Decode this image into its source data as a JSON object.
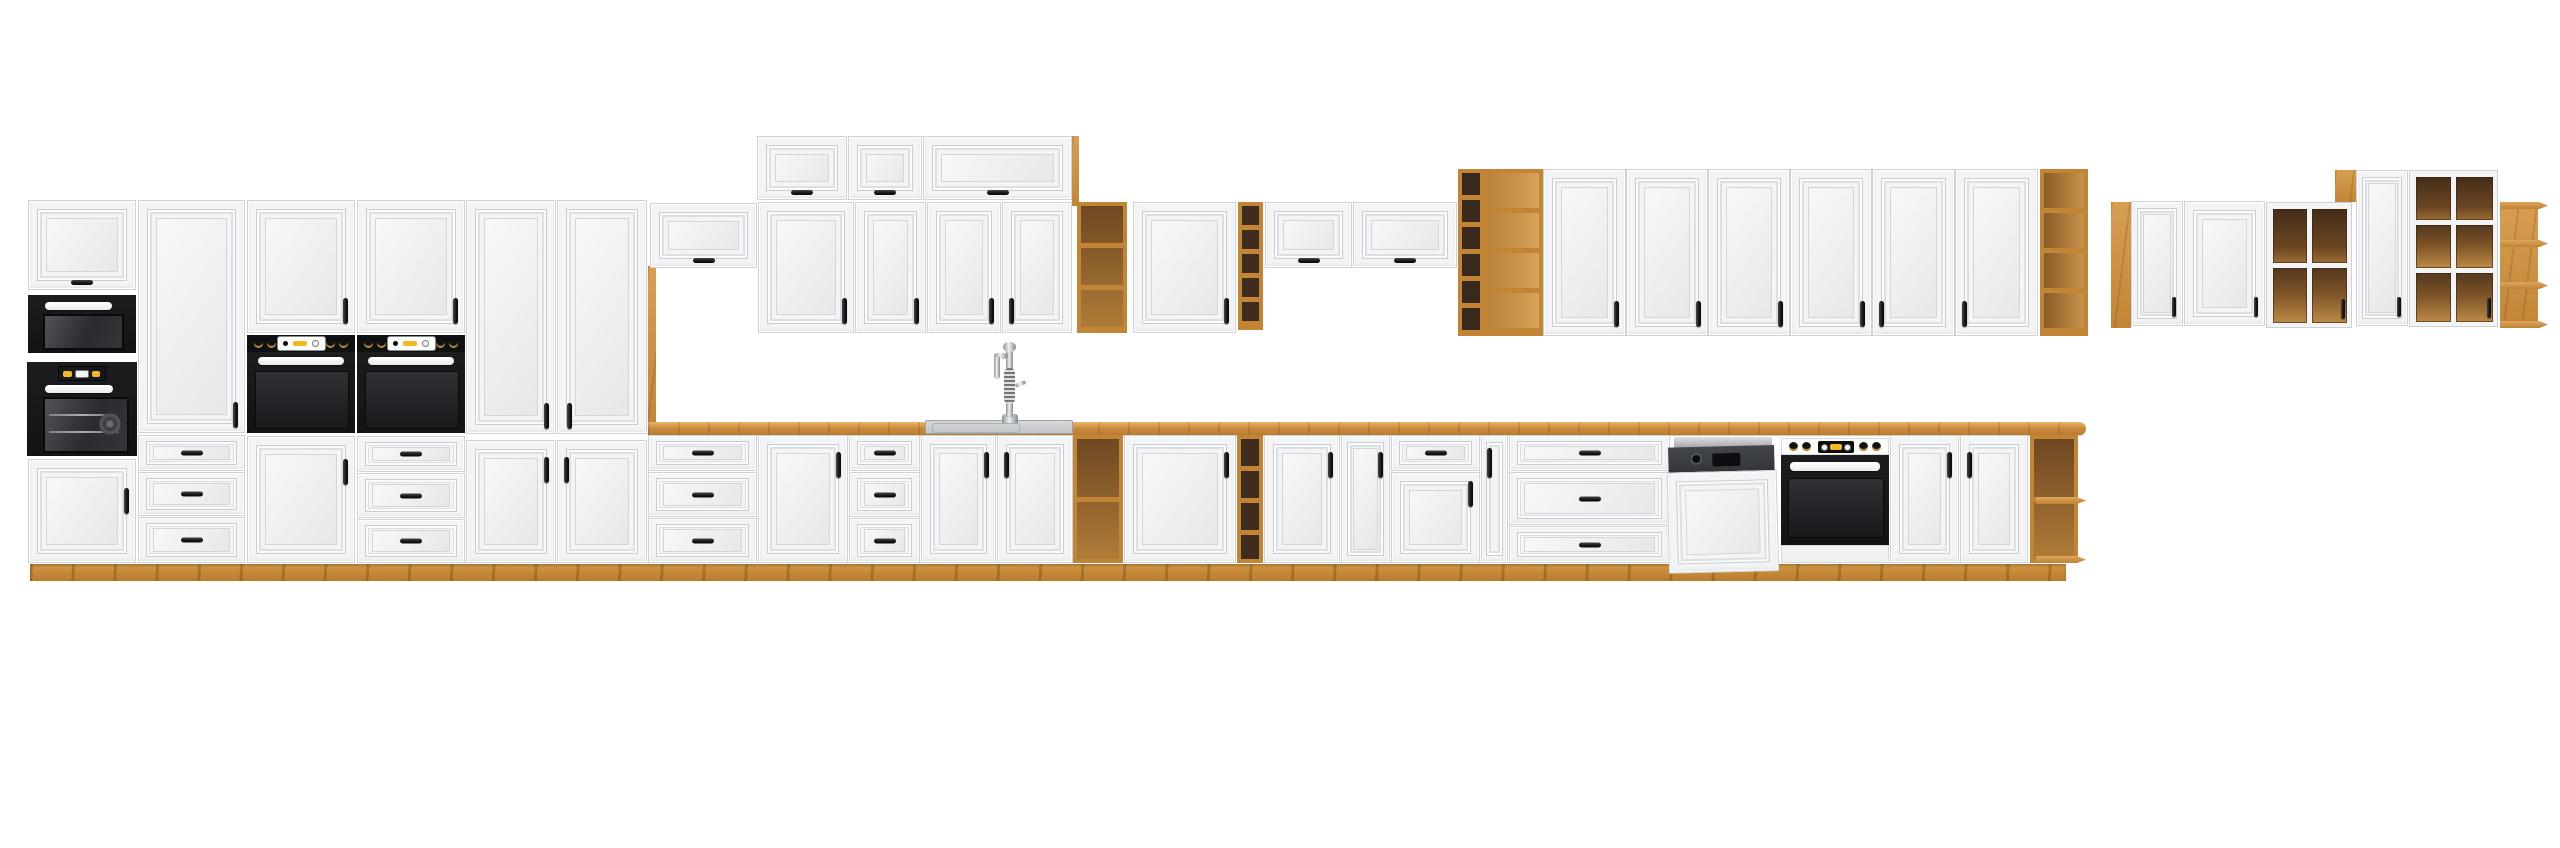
{
  "image_type": "product-photo-render",
  "subject": "modular-kitchen-cabinet-set-panorama",
  "canvas": {
    "width": 2560,
    "height": 848
  },
  "style": {
    "background": "#ffffff",
    "front_color": "#f3f4f5",
    "seam": "#cfd2d5",
    "carcass_oak": "#c28536",
    "oak_light": "#d89f52",
    "oak_dark": "#a66c26",
    "countertop_front": "#b97c2f",
    "plinth_oak": "#c88b3a",
    "interior_dark": "#3e2d1f",
    "appliance_black": "#141517",
    "appliance_panel": "#3a3d40",
    "steel": "#c3c7ca",
    "accent_yellow": "#f2b824",
    "knob_gold": "#b98d3c",
    "handle_black": "#1b1c1e"
  },
  "groups": [
    {
      "name": "tall-appliance-block",
      "units": [
        "flip-cabinet-microwave-oven-column",
        "pantry-with-three-drawers",
        "oven-housing-with-door",
        "oven-housing-with-drawers"
      ]
    },
    {
      "name": "main-sink-run",
      "units": [
        "two-tall-pantries",
        "over-fridge-flip-cabinet",
        "three-top-flip-cabinets",
        "five-wall-doors",
        "oak-open-wall-shelf",
        "narrow-oak-cubby-tower",
        "two-flip-cabinets",
        "sink-base-cabinets",
        "oak-open-base-shelves",
        "cargo-unit",
        "drawer-units",
        "corner-open-base-shelf"
      ]
    },
    {
      "name": "tall-wall-run",
      "units": [
        "oak-shelf-tower",
        "six-wall-doors",
        "oak-end-shelf"
      ]
    },
    {
      "name": "right-wall-group",
      "units": [
        "oak-side-panel",
        "two-doors",
        "glass-door-2x2",
        "oak-top-box",
        "tall-door",
        "glass-door-2x3",
        "corner-open-shelf"
      ]
    }
  ],
  "appliances": [
    {
      "name": "microwave",
      "finish": "black"
    },
    {
      "name": "compact-oven",
      "finish": "black",
      "display": "digital"
    },
    {
      "name": "built-in-oven-pair",
      "finish": "black-with-knob-panel"
    },
    {
      "name": "dishwasher",
      "state": "door-ajar",
      "finish": "white-front"
    },
    {
      "name": "built-in-oven",
      "finish": "black-with-white-knob-strip"
    },
    {
      "name": "flat-sink",
      "finish": "steel-gray"
    },
    {
      "name": "spring-neck-faucet",
      "finish": "chrome"
    }
  ]
}
